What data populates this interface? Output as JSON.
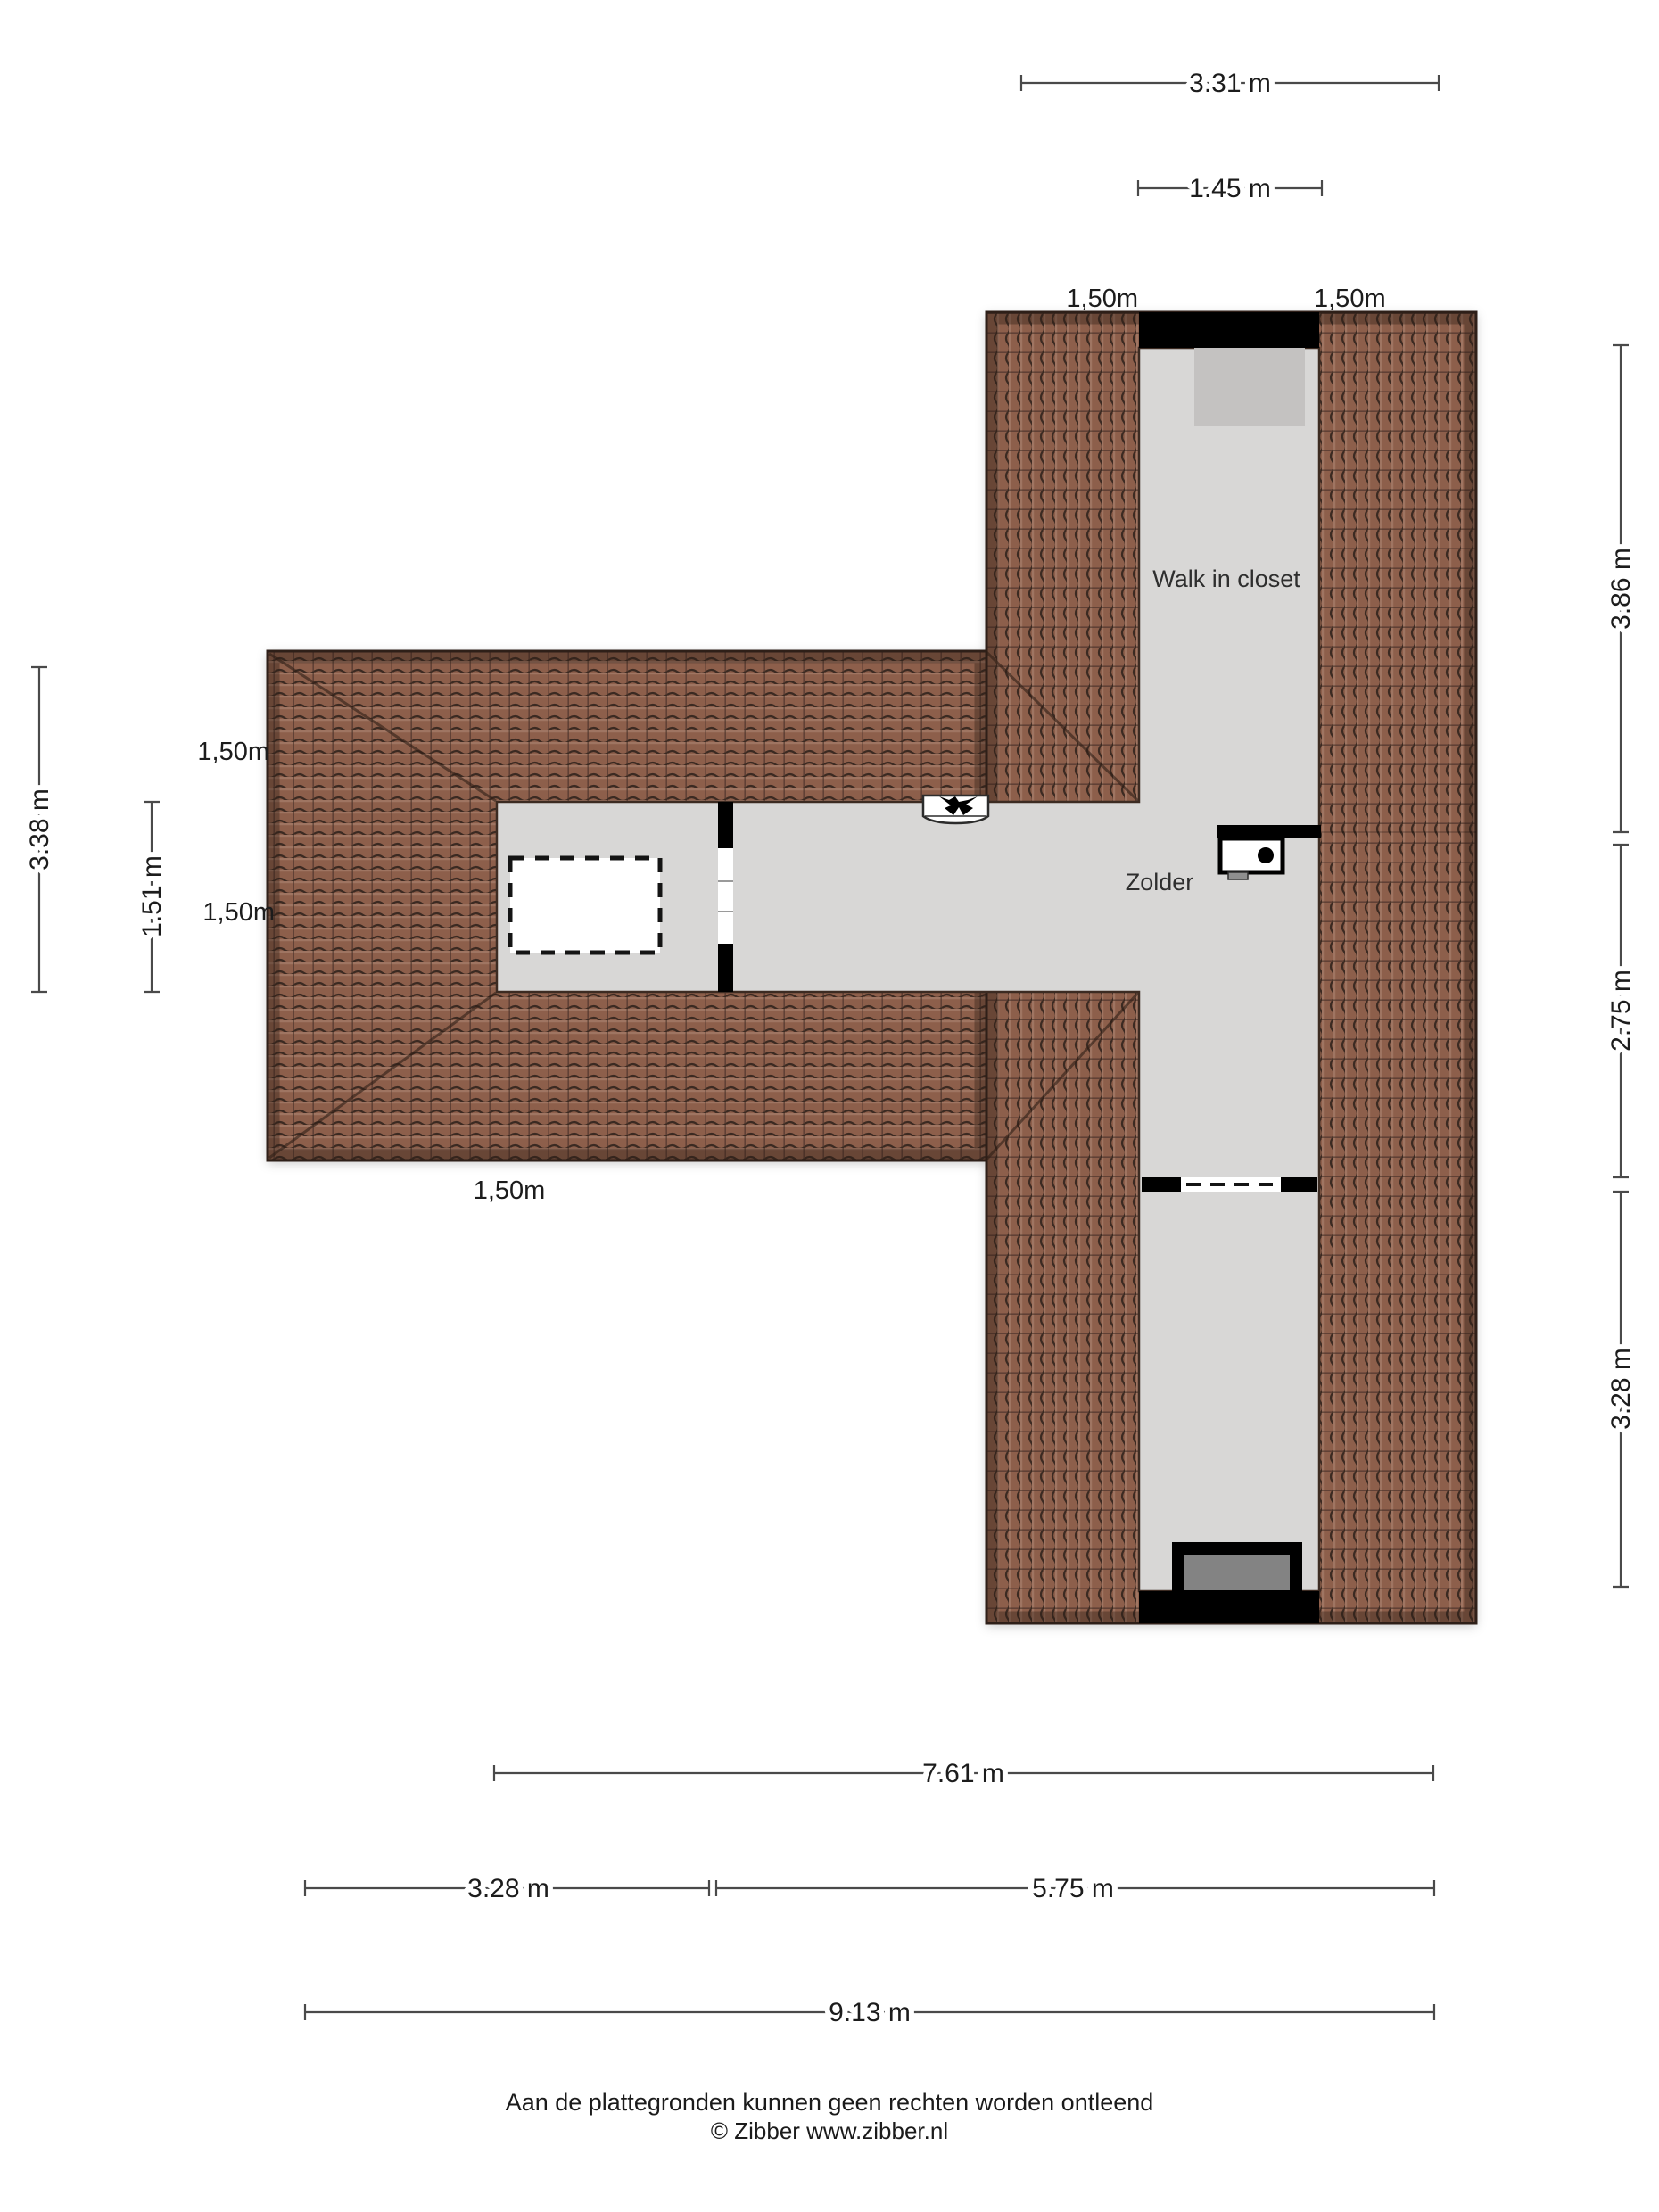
{
  "rooms": {
    "walk_in_closet": "Walk in closet",
    "zolder": "Zolder"
  },
  "dimensions": {
    "top_overall": "3.31 m",
    "top_closet": "1.45 m",
    "right_top": "3.86 m",
    "right_mid": "2.75 m",
    "right_bottom": "3.28 m",
    "left_outer": "3.38 m",
    "left_inner": "1.51 m",
    "bottom_span": "7.61 m",
    "bottom_left": "3.28 m",
    "bottom_right": "5.75 m",
    "bottom_overall": "9.13 m"
  },
  "roof_marks": {
    "top_left": "1,50m",
    "top_right": "1,50m",
    "left_upper": "1,50m",
    "left_lower": "1,50m",
    "bottom_center": "1,50m"
  },
  "footer": {
    "line1": "Aan de plattegronden kunnen geen rechten worden ontleend",
    "line2": "© Zibber www.zibber.nl"
  },
  "colors": {
    "wall": "#000000",
    "floor": "#d8d7d6",
    "roof_base": "#8d5e4b",
    "dimension": "#4a4a4a",
    "closet_box": "#c4c2c1",
    "dormer_inner": "#838383"
  }
}
